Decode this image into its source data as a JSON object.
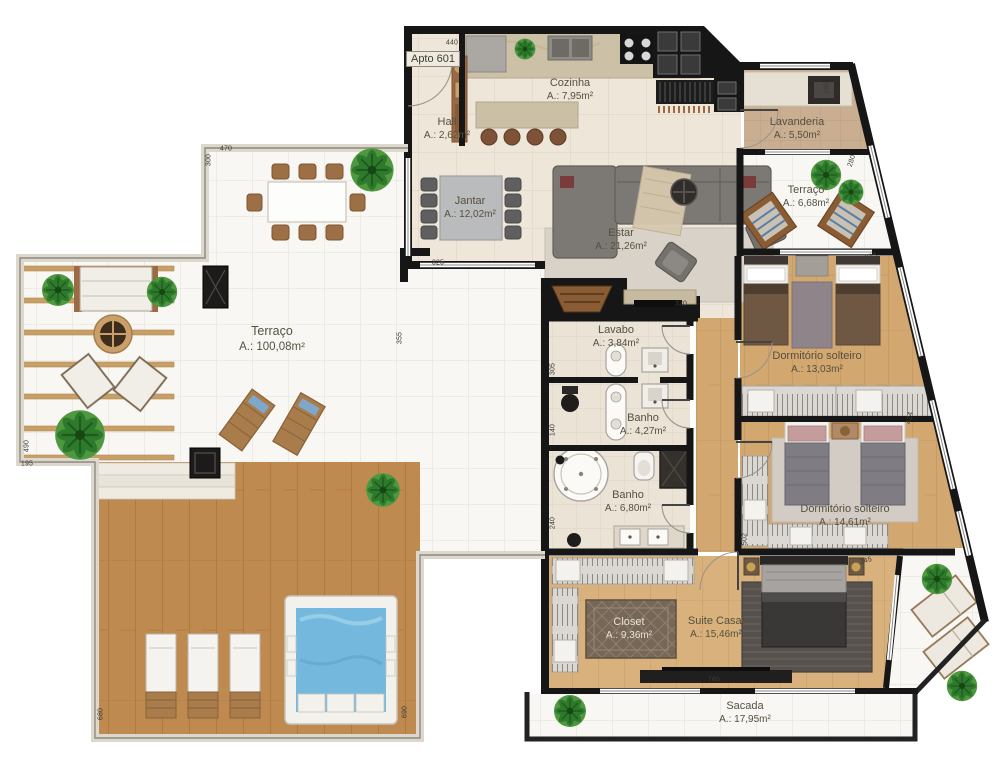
{
  "plan": {
    "unit_label": "Apto 601",
    "rooms": [
      {
        "name": "Cozinha",
        "area": "A.: 7,95m²"
      },
      {
        "name": "Hall",
        "area": "A.: 2,62m²"
      },
      {
        "name": "Lavanderia",
        "area": "A.: 5,50m²"
      },
      {
        "name": "Terraço",
        "area": "A.: 6,68m²"
      },
      {
        "name": "Jantar",
        "area": "A.: 12,02m²"
      },
      {
        "name": "Estar",
        "area": "A.: 21,26m²"
      },
      {
        "name": "Lavabo",
        "area": "A.: 3,84m²"
      },
      {
        "name": "Banho",
        "area": "A.: 4,27m²"
      },
      {
        "name": "Banho",
        "area": "A.: 6,80m²"
      },
      {
        "name": "Dormitório solteiro",
        "area": "A.: 13,03m²"
      },
      {
        "name": "Dormitório solteiro",
        "area": "A.: 14,61m²"
      },
      {
        "name": "Terraço",
        "area": "A.: 100,08m²"
      },
      {
        "name": "Closet",
        "area": "A.: 9,36m²"
      },
      {
        "name": "Suite Casal",
        "area": "A.: 15,46m²"
      },
      {
        "name": "Sacada",
        "area": "A.: 17,95m²"
      }
    ],
    "dimensions": [
      {
        "t": "440",
        "x": 452,
        "y": 43,
        "r": 0
      },
      {
        "t": "470",
        "x": 226,
        "y": 149,
        "r": 0
      },
      {
        "t": "300",
        "x": 209,
        "y": 160,
        "r": -90
      },
      {
        "t": "325",
        "x": 438,
        "y": 263,
        "r": 0
      },
      {
        "t": "355",
        "x": 400,
        "y": 338,
        "r": -90
      },
      {
        "t": "320",
        "x": 681,
        "y": 304,
        "r": 0
      },
      {
        "t": "305",
        "x": 553,
        "y": 369,
        "r": -90
      },
      {
        "t": "140",
        "x": 553,
        "y": 430,
        "r": -90
      },
      {
        "t": "240",
        "x": 553,
        "y": 523,
        "r": -90
      },
      {
        "t": "160",
        "x": 827,
        "y": 88,
        "r": -90
      },
      {
        "t": "280",
        "x": 852,
        "y": 161,
        "r": -72
      },
      {
        "t": "233",
        "x": 871,
        "y": 257,
        "r": -15
      },
      {
        "t": "424",
        "x": 910,
        "y": 418,
        "r": -78
      },
      {
        "t": "502",
        "x": 745,
        "y": 539,
        "r": -90
      },
      {
        "t": "765",
        "x": 714,
        "y": 680,
        "r": 0
      },
      {
        "t": "245",
        "x": 866,
        "y": 561,
        "r": -15
      },
      {
        "t": "680",
        "x": 101,
        "y": 714,
        "r": -90
      },
      {
        "t": "690",
        "x": 405,
        "y": 712,
        "r": -90
      },
      {
        "t": "195",
        "x": 27,
        "y": 464,
        "r": 0
      },
      {
        "t": "490",
        "x": 27,
        "y": 446,
        "r": -90
      }
    ],
    "colors": {
      "wall": "#161616",
      "interior_floor": "#EDE6D9",
      "terrace_tile": "#F8F7F4",
      "wood_floor": "#D2A770",
      "deck_wood": "#BE8A50",
      "pool_water": "#74B8DD",
      "plant_green": "#4F9840",
      "label_text": "#55503F"
    }
  }
}
